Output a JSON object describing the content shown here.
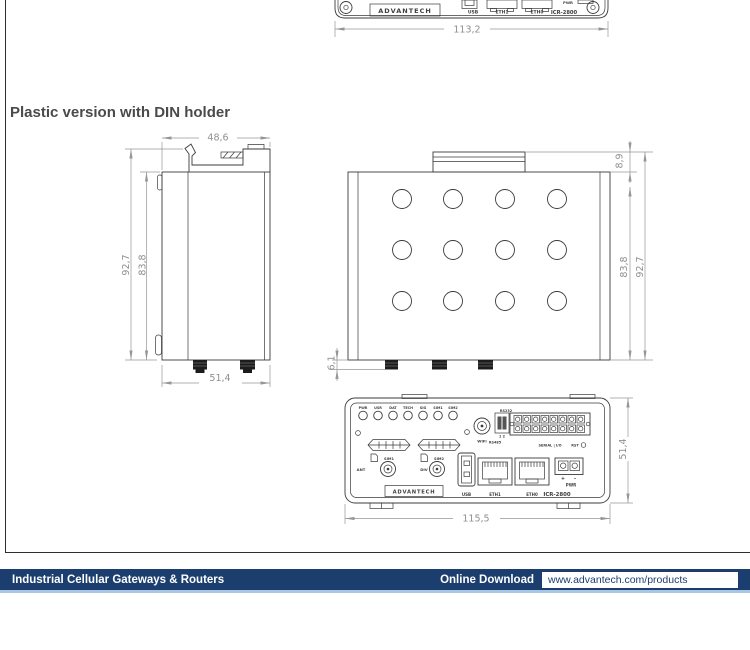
{
  "heading": "Plastic version with DIN holder",
  "colors": {
    "footer_bar": "#1b3e6f",
    "footer_accent_line": "#a9c7e5",
    "drawing_line": "#3b3b3b",
    "dimension_gray": "#8f8f8f"
  },
  "top_drawing": {
    "brand": "ADVANTECH",
    "usb": "USB",
    "eth1": "ETH1",
    "eth0": "ETH0",
    "model": "ICR-2800",
    "pwr": "PWR",
    "dim_width": "113,2"
  },
  "side_view": {
    "dim_top_width": "48,6",
    "dim_height_outer": "92,7",
    "dim_height_body": "83,8",
    "dim_bottom_width": "51,4"
  },
  "top_view": {
    "dim_clip": "8,9",
    "dim_height_body": "83,8",
    "dim_height_outer": "92,7",
    "dim_connector": "6,1"
  },
  "front_panel": {
    "led_labels": [
      "PWR",
      "USR",
      "DAT",
      "TECH",
      "SIG",
      "SIM1",
      "SIM2"
    ],
    "sim1_label": "SIM1",
    "sim2_label": "SIM2",
    "ant_label": "ANT",
    "div_label": "DIV",
    "wifi_label": "WiFi",
    "rs232_label": "RS232",
    "switch_positions": "1 2",
    "rs485_label": "RS485",
    "serial_io_label": "SERIAL | I/O",
    "rst_label": "RST",
    "plus_sign": "+",
    "minus_sign": "-",
    "pwr_label": "PWR",
    "usb_label": "USB",
    "eth1_label": "ETH1",
    "eth0_label": "ETH0",
    "model": "ICR-2800",
    "brand": "ADVANTECH",
    "dim_height": "51,4",
    "dim_width": "115,5"
  },
  "footer": {
    "left_text": "Industrial Cellular Gateways & Routers",
    "download_label": "Online Download",
    "download_url": "www.advantech.com/products"
  }
}
